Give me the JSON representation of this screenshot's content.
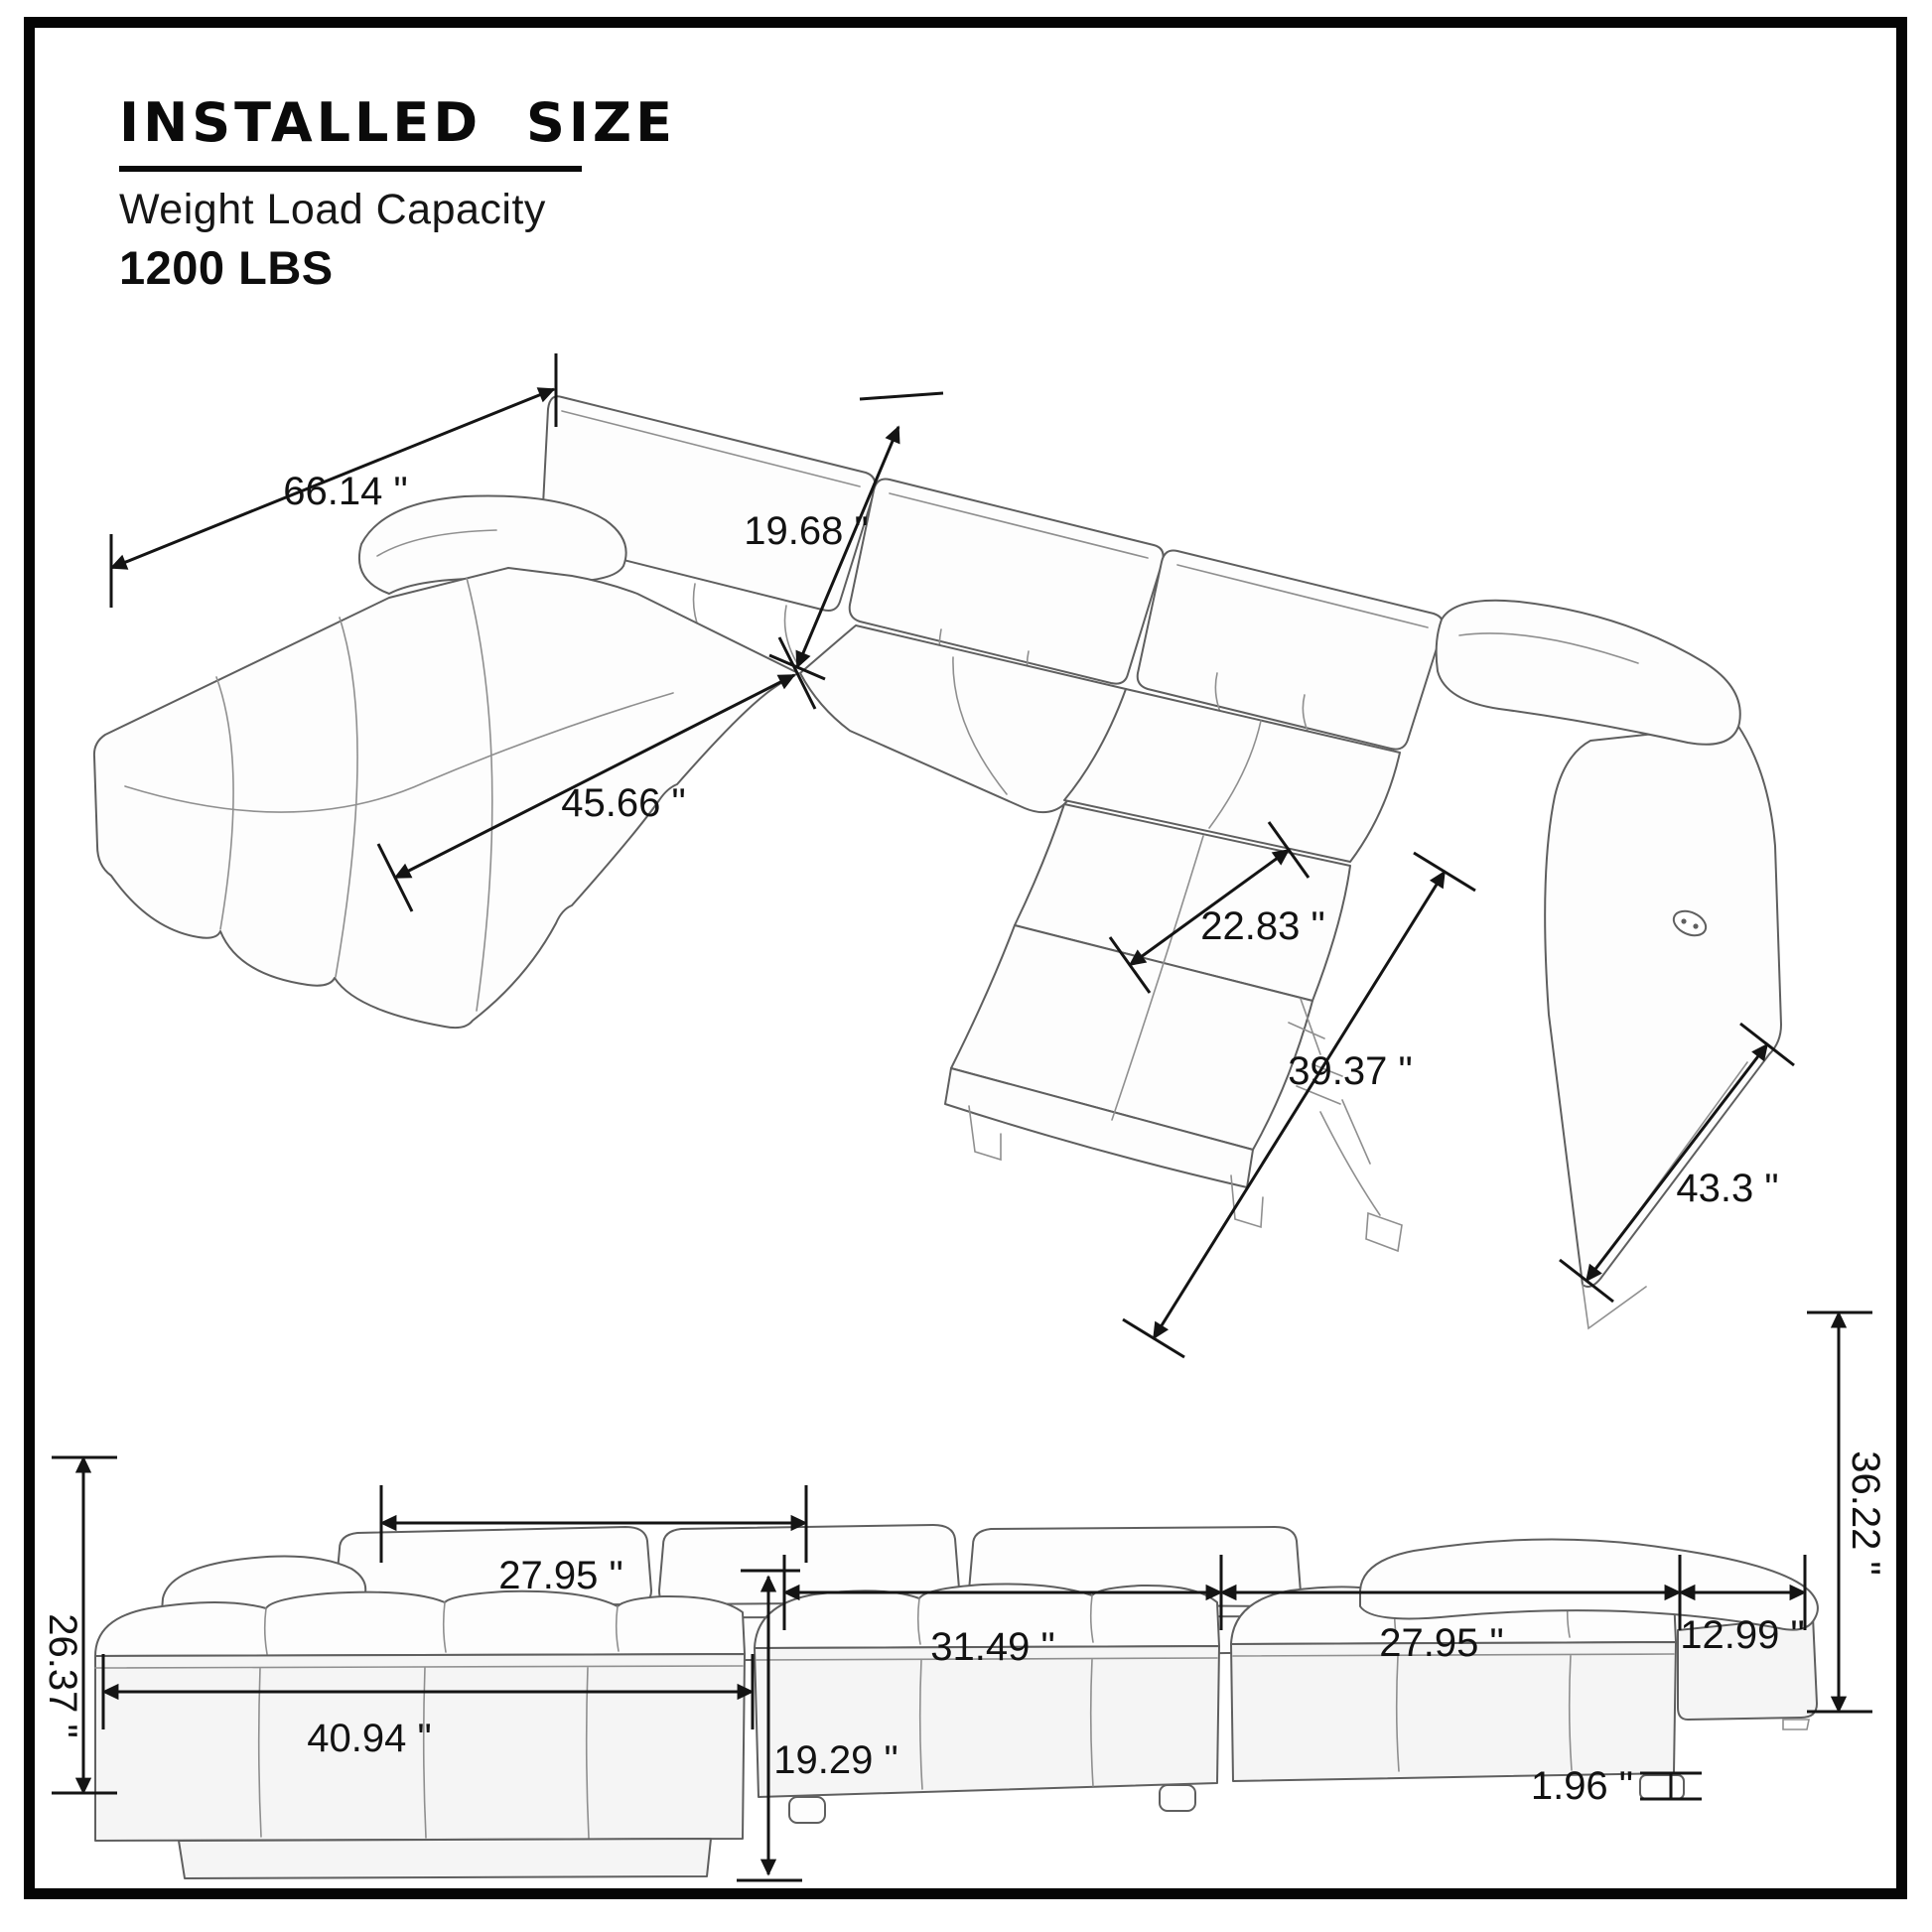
{
  "header": {
    "title": "INSTALLED SIZE",
    "subtitle": "Weight Load Capacity",
    "capacity": "1200 LBS"
  },
  "views": {
    "perspective": {
      "dims": {
        "back_width": "66.14 \"",
        "backrest_height": "19.68 \"",
        "chaise_length": "45.66 \"",
        "recliner_seat_width": "22.83 \"",
        "recliner_extended_length": "39.37 \"",
        "side_depth": "43.3 \""
      }
    },
    "front": {
      "dims": {
        "chaise_seat_height": "26.37 \"",
        "chaise_seat_width": "27.95 \"",
        "middle_seat_width": "31.49 \"",
        "right_seat_width": "27.95 \"",
        "armrest_width": "12.99 \"",
        "overall_height": "36.22 \"",
        "chaise_front_width": "40.94 \"",
        "seat_front_height": "19.29 \"",
        "leg_height": "1.96 \""
      }
    }
  }
}
